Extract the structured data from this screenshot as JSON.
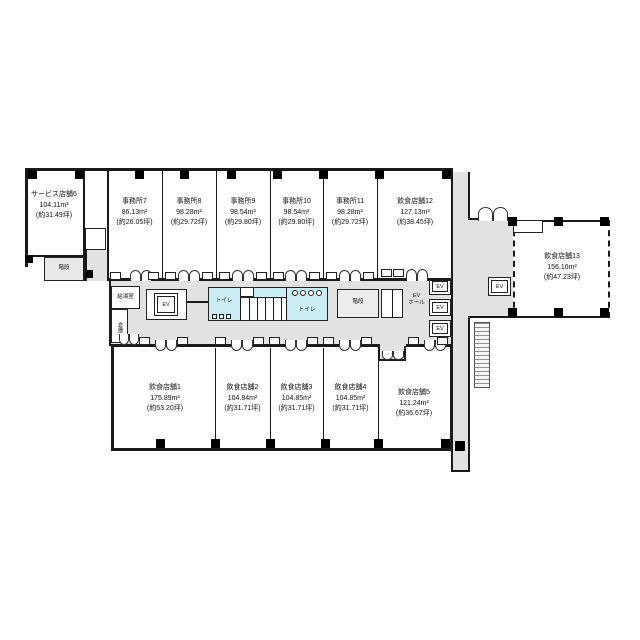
{
  "floorplan": {
    "top_rooms": [
      {
        "name": "サービス店舗6",
        "area": "104.11m²",
        "tsubo": "(約31.49坪)"
      },
      {
        "name": "事務所7",
        "area": "86.13m²",
        "tsubo": "(約26.05坪)"
      },
      {
        "name": "事務所8",
        "area": "98.28m²",
        "tsubo": "(約29.72坪)"
      },
      {
        "name": "事務所9",
        "area": "98.54m²",
        "tsubo": "(約29.80坪)"
      },
      {
        "name": "事務所10",
        "area": "98.54m²",
        "tsubo": "(約29.80坪)"
      },
      {
        "name": "事務所11",
        "area": "98.28m²",
        "tsubo": "(約29.72坪)"
      },
      {
        "name": "飲食店舗12",
        "area": "127.13m²",
        "tsubo": "(約38.45坪)"
      }
    ],
    "bottom_rooms": [
      {
        "name": "飲食店舗1",
        "area": "175.89m²",
        "tsubo": "(約53.20坪)"
      },
      {
        "name": "飲食店舗2",
        "area": "104.84m²",
        "tsubo": "(約31.71坪)"
      },
      {
        "name": "飲食店舗3",
        "area": "104.85m²",
        "tsubo": "(約31.71坪)"
      },
      {
        "name": "飲食店舗4",
        "area": "104.85m²",
        "tsubo": "(約31.71坪)"
      },
      {
        "name": "飲食店舗5",
        "area": "121.24m²",
        "tsubo": "(約36.67坪)"
      }
    ],
    "right_room": {
      "name": "飲食店舗13",
      "area": "156.16m²",
      "tsubo": "(約47.23坪)"
    },
    "core": {
      "stair_left": "階段",
      "stair_mid": "階段",
      "kitchenette": "給湯室",
      "storage": "倉庫",
      "toilet_left": "トイレ",
      "toilet_right": "トイレ",
      "ev": "EV",
      "ev_hall_line1": "EV",
      "ev_hall_line2": "ホール"
    },
    "colors": {
      "corridor": "#e2e2e2",
      "toilet_area": "#c9edf2",
      "wall": "#1a1a1a",
      "stair_fill": "#e8e8e8"
    }
  }
}
